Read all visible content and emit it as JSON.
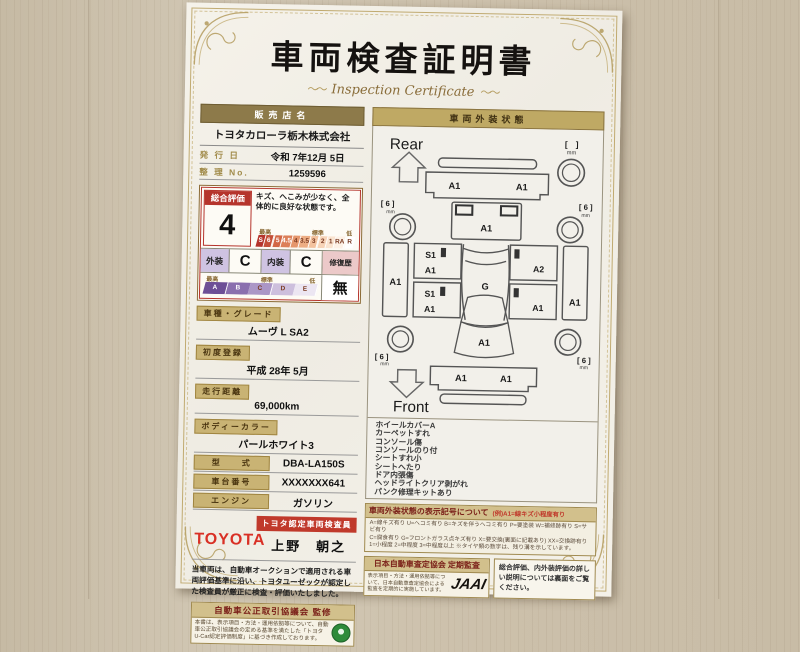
{
  "colors": {
    "accent_red": "#b5342c",
    "bar_gold": "#8d7a4a",
    "label_gold": "#c9b374",
    "grade_scale_colors": [
      "#b5342c",
      "#c44f38",
      "#d26746",
      "#dc7f58",
      "#e5966c",
      "#edad84",
      "#f3c29e",
      "#f7d4b8",
      "#fae4d0",
      "#fdf1e6",
      "#ffffff"
    ],
    "letter_scale_colors": [
      "#6d4f96",
      "#8a6fae",
      "#ab96c6",
      "#cdbfdd",
      "#ece6f2"
    ]
  },
  "certificate": {
    "title": "車両検査証明書",
    "subtitle": "Inspection Certificate",
    "flourish": "〜〜"
  },
  "dealer": {
    "label": "販売店名",
    "name": "トヨタカローラ栃木株式会社",
    "issue_label": "発 行 日",
    "issue_value": "令和 7年12月 5日",
    "ref_label": "整 理 No.",
    "ref_value": "1259596"
  },
  "evaluation": {
    "overall_label": "総合評価",
    "overall_grade": "4",
    "comment": "キズ、へこみが少なく、全体的に良好な状態です。",
    "scale_high": "最高",
    "scale_mid": "標準",
    "scale_low": "低",
    "grade_scale": [
      "S",
      "6",
      "5",
      "4.5",
      "4",
      "3.5",
      "3",
      "2",
      "1",
      "RA",
      "R"
    ],
    "exterior_label": "外装",
    "exterior_grade": "C",
    "interior_label": "内装",
    "interior_grade": "C",
    "repair_label": "修復歴",
    "repair_value": "無",
    "letter_scale": [
      "A",
      "B",
      "C",
      "D",
      "E"
    ]
  },
  "specs": [
    {
      "label": "車種・グレード",
      "value": "ムーヴ L SA2"
    },
    {
      "label": "初度登録",
      "value": "平成 28年 5月"
    },
    {
      "label": "走行距離",
      "value": "69,000km"
    },
    {
      "label": "ボディーカラー",
      "value": "パールホワイト3"
    },
    {
      "label": "型　　式",
      "value": "DBA-LA150S"
    },
    {
      "label": "車台番号",
      "value": "XXXXXXX641"
    },
    {
      "label": "エンジン",
      "value": "ガソリン"
    }
  ],
  "inspector": {
    "brand": "TOYOTA",
    "badge": "トヨタ認定車両検査員",
    "name": "上野　朝之"
  },
  "disclaimer": "当車両は、自動車オークションで適用される車両評価基準に沿い、トヨタユーゼックが認定した検査員が厳正に検査・評価いたしました。",
  "exterior": {
    "header": "車両外装状態",
    "rear_label": "Rear",
    "front_label": "Front",
    "marks": {
      "rear_bumper_left": "A1",
      "rear_bumper_right": "A1",
      "tailgate": "A1",
      "left_quarter": "A1",
      "left_rear_door_upper": "S1",
      "left_rear_door_lower": "A1",
      "left_front_door_upper": "S1",
      "left_front_door_lower": "A1",
      "right_rear_door": "A2",
      "right_front_door": "A1",
      "right_quarter": "A1",
      "windshield": "G",
      "hood": "A1",
      "front_bumper_left": "A1",
      "front_bumper_right": "A1"
    },
    "tires": {
      "rear_left": "[ 6 ]",
      "rear_right": "[ 6 ]",
      "front_left": "[ 6 ]",
      "front_right": "[ 6 ]",
      "spare": "[　]",
      "unit": "mm"
    },
    "notes": [
      "ホイールカバーA",
      "カーペットすれ",
      "コンソール傷",
      "コンソールのり付",
      "シートすれ小",
      "シートへたり",
      "ドア内張傷",
      "ヘッドライトクリア剥がれ",
      "パンク修理キットあり"
    ]
  },
  "legend": {
    "title": "車両外装状態の表示記号について",
    "example": "(例)A1=線キズ小程度有り",
    "lines": [
      "A=線キズ有り U=ヘコミ有り B=キズを伴うヘコミ有り P=要塗装 W=補修跡有り S=サビ有り",
      "C=腐食有り G=フロントガラス点キズ有り X=要交換(裏面に記載あり) XX=交換跡有り",
      "1=小程度 2=中程度 3=中程度以上 ※タイヤ類の数字は、残り溝を示しています。"
    ]
  },
  "footer": {
    "fair_trade_title": "自動車公正取引協議会 監修",
    "fair_trade_body": "本書は、表示項目・方法・運用依拠等について、自動車公正取引協議会の定める基準を満たした「トヨタU-Car認定評価制度」に基づき作成しております。",
    "jaai_title": "日本自動車査定協会 定期監査",
    "jaai_body": "表示項目・方法・運用依拠等について、日本自動車査定協会による監査を定期的に実施しています。",
    "jaai_logo": "JAAI",
    "back_note": "総合評価、内外装評価の詳しい説明については裏面をご覧ください。"
  }
}
